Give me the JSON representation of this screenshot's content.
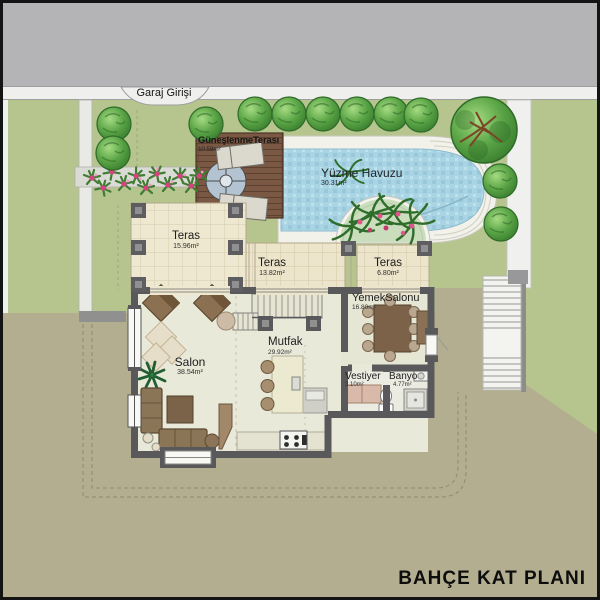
{
  "title": "BAHÇE KAT PLANI",
  "street": {
    "garage_entry_label": "Garaj Girişi"
  },
  "pool": {
    "name": "Yüzme Havuzu",
    "area": "30.31m²"
  },
  "sun_terrace": {
    "name": "GüneşlenmeTerası",
    "area": "10.59m²"
  },
  "rooms": {
    "teras_left": {
      "name": "Teras",
      "area": "15.96m²"
    },
    "teras_middle": {
      "name": "Teras",
      "area": "13.82m²"
    },
    "teras_right": {
      "name": "Teras",
      "area": "6.80m²"
    },
    "yemek_salonu": {
      "name": "YemekSalonu",
      "area": "16.80m²"
    },
    "salon": {
      "name": "Salon",
      "area": "38.54m²"
    },
    "mutfak": {
      "name": "Mutfak",
      "area": "29.92m²"
    },
    "vestiyer": {
      "name": "Vestiyer",
      "area": "3.10m²"
    },
    "banyo": {
      "name": "Banyo",
      "area": "4.77m²"
    }
  },
  "colors": {
    "road": "#b4b4b6",
    "sidewalk": "#efefed",
    "lawn": "#b6c48e",
    "lower_garden": "#b3ae8f",
    "pool_water": "#a9d4e4",
    "deck_wood": "#7a5843",
    "wall": "#59595b",
    "terrace_floor": "#efe8d0",
    "interior_floor": "#e9e9da",
    "tree_green": "#4f9540",
    "flower_pink": "#d6417e"
  }
}
